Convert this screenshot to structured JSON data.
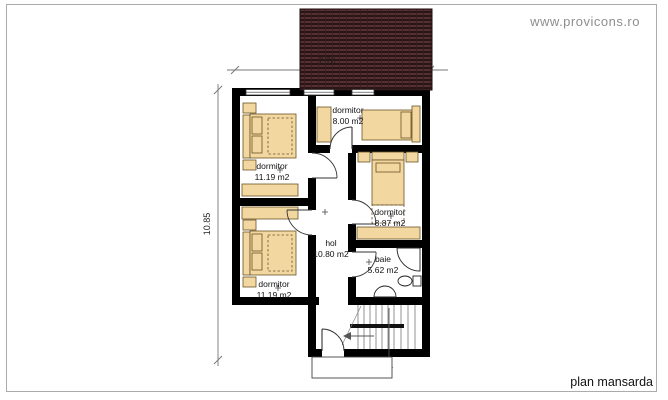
{
  "sheet": {
    "watermark": "www.provicons.ro",
    "title": "plan mansarda"
  },
  "dimensions": {
    "width": "7.70",
    "height": "10.85"
  },
  "rooms": [
    {
      "name": "dormitor",
      "area": "8.00 m2"
    },
    {
      "name": "dormitor",
      "area": "11.19 m2"
    },
    {
      "name": "dormitor",
      "area": "8.87 m2"
    },
    {
      "name": "dormitor",
      "area": "11.19 m2"
    },
    {
      "name": "hol",
      "area": "10.80 m2"
    },
    {
      "name": "baie",
      "area": "5.62 m2"
    }
  ],
  "colors": {
    "wall": "#000000",
    "furniture": "#f2d7a0",
    "roof_base": "#553031",
    "roof_grid": "#2a1516",
    "dimension_line": "#777777",
    "watermark_gray": "#8e8e8e"
  }
}
